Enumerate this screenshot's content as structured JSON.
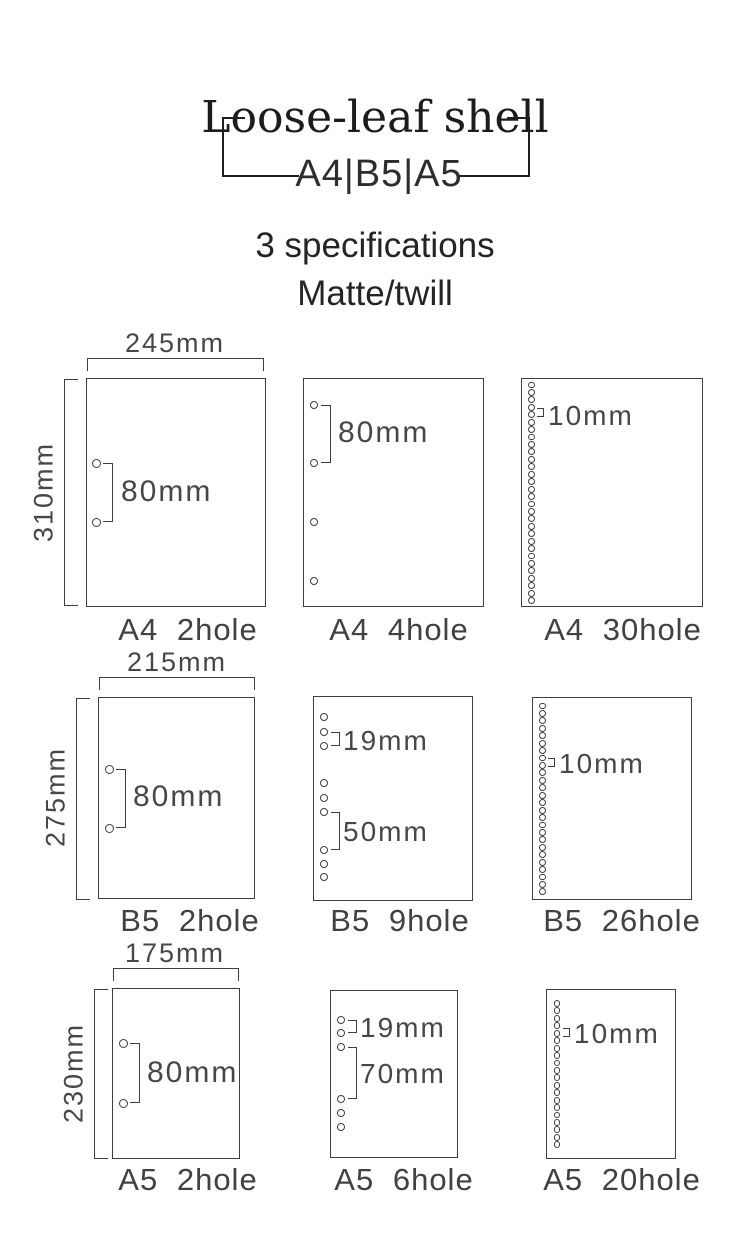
{
  "header": {
    "title": "Loose-leaf shell",
    "sizes": "A4|B5|A5",
    "spec_count": "3 specifications",
    "finish": "Matte/twill"
  },
  "colors": {
    "background": "#ffffff",
    "line": "#3e3e42",
    "header_text": "#1c1c1c",
    "label_text": "#47474b"
  },
  "panels": {
    "a4_2hole": {
      "caption": "A4 2hole",
      "width": "245mm",
      "height": "310mm",
      "pitch": "80mm",
      "holes": 2
    },
    "a4_4hole": {
      "caption": "A4 4hole",
      "pitch": "80mm",
      "holes": 4
    },
    "a4_30hole": {
      "caption": "A4 30hole",
      "pitch": "10mm",
      "holes": 30
    },
    "b5_2hole": {
      "caption": "B5 2hole",
      "width": "215mm",
      "height": "275mm",
      "pitch": "80mm",
      "holes": 2
    },
    "b5_9hole": {
      "caption": "B5 9hole",
      "pitch_small": "19mm",
      "pitch_large": "50mm",
      "holes": 9
    },
    "b5_26hole": {
      "caption": "B5 26hole",
      "pitch": "10mm",
      "holes": 26
    },
    "a5_2hole": {
      "caption": "A5 2hole",
      "width": "175mm",
      "height": "230mm",
      "pitch": "80mm",
      "holes": 2
    },
    "a5_6hole": {
      "caption": "A5 6hole",
      "pitch_small": "19mm",
      "pitch_large": "70mm",
      "holes": 6
    },
    "a5_20hole": {
      "caption": "A5 20hole",
      "pitch": "10mm",
      "holes": 20
    }
  }
}
